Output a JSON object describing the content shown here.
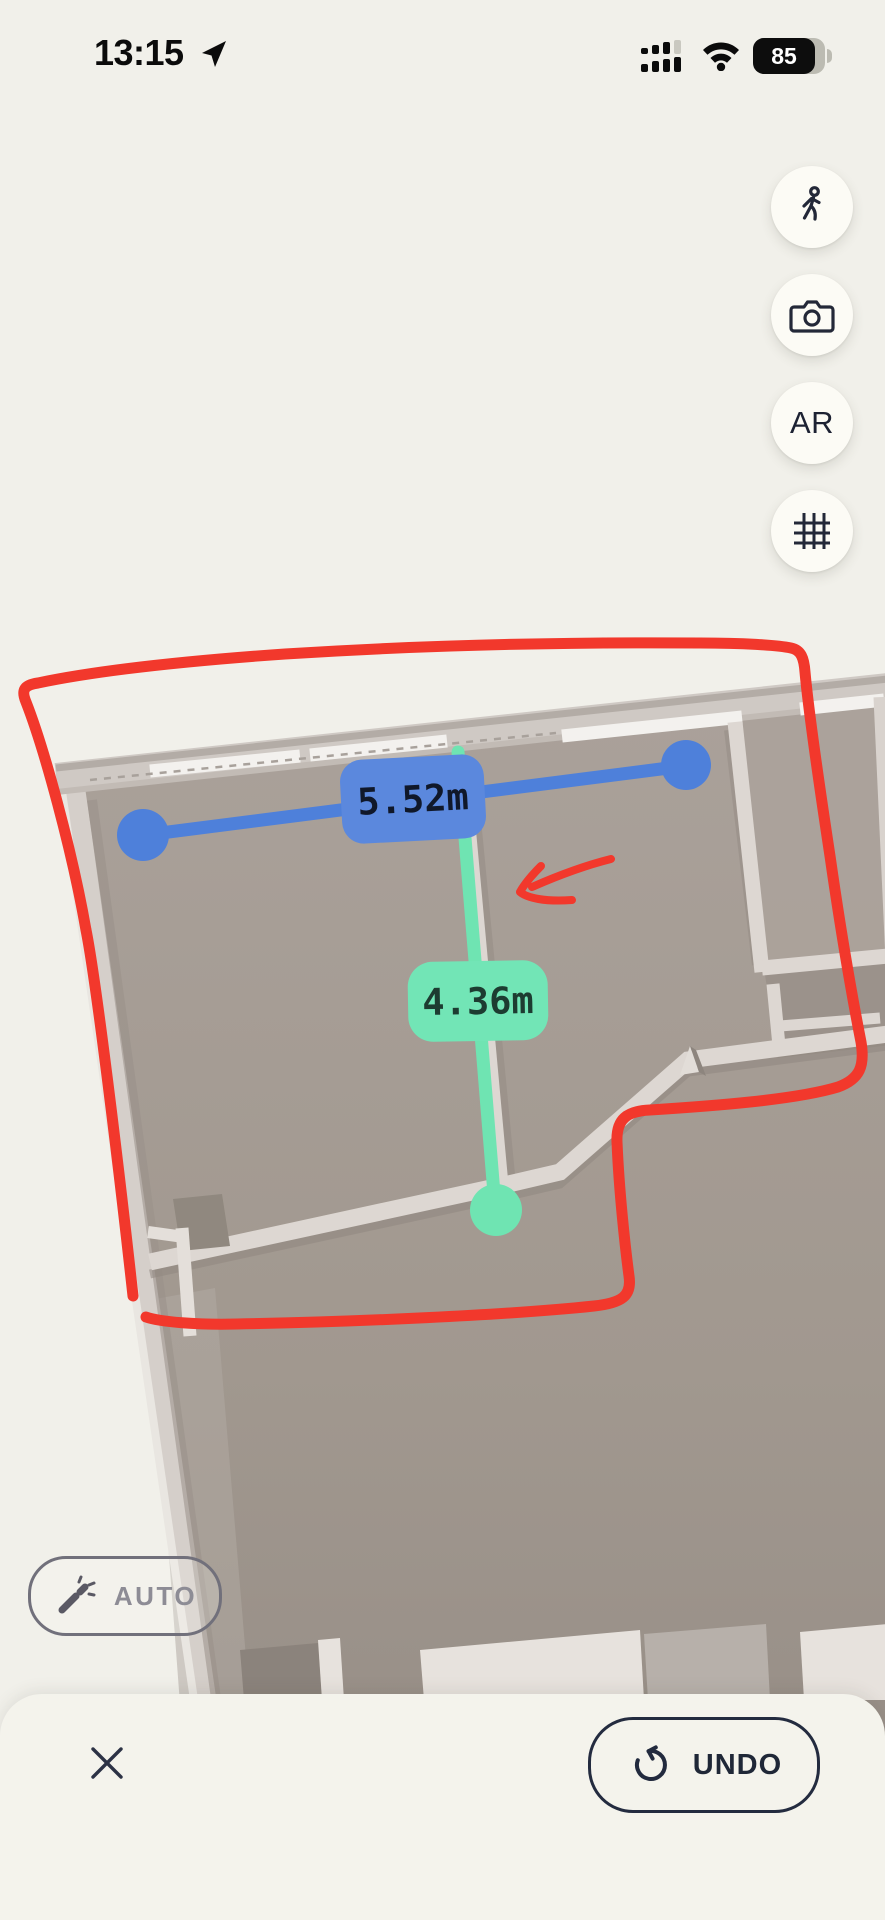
{
  "status_bar": {
    "time": "13:15",
    "battery_percent": "85"
  },
  "side_controls": {
    "walk": {
      "icon": "walking-person-icon"
    },
    "camera": {
      "icon": "camera-icon"
    },
    "ar": {
      "label": "AR"
    },
    "grid": {
      "icon": "grid-icon"
    }
  },
  "measurements": {
    "horizontal": {
      "value": "5.52m",
      "color": "#4e80da"
    },
    "vertical": {
      "value": "4.36m",
      "color": "#6fe4b2"
    }
  },
  "auto_button": {
    "label": "AUTO"
  },
  "bottom_bar": {
    "undo_label": "UNDO"
  },
  "colors": {
    "background": "#f1f0ea",
    "sheet": "#f4f3ec",
    "annotation_red": "#f2382c",
    "measure_blue": "#4e80da",
    "measure_green": "#6fe4b2",
    "icon_dark": "#232838"
  }
}
